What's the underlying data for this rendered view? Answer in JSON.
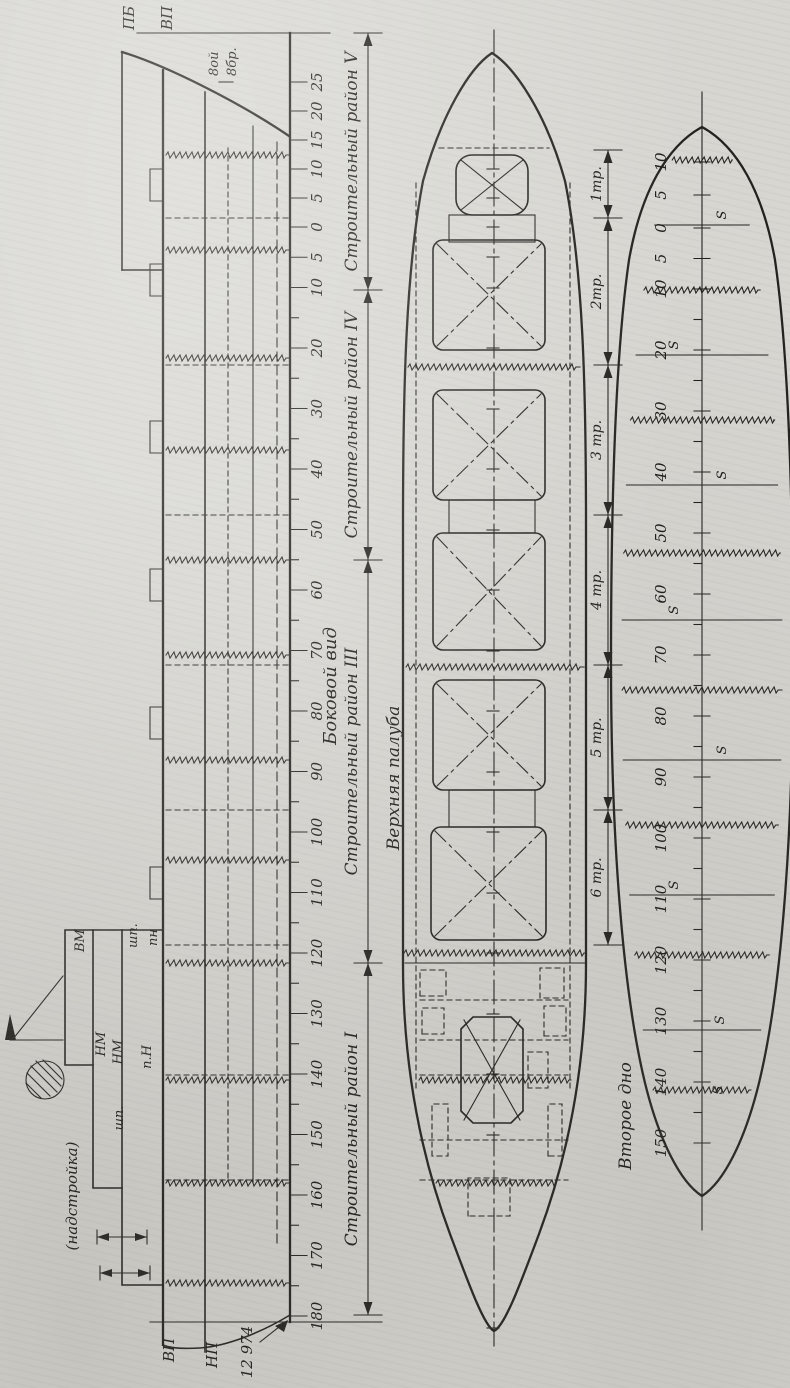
{
  "figure_titles": {
    "side_view": "Боковой вид",
    "upper_deck": "Верхняя палуба",
    "double_bottom": "Второе дно"
  },
  "deck_line_labels": {
    "pb": "ПБ",
    "vp": "ВП"
  },
  "stern_line_labels": {
    "vp": "ВП",
    "np": "НП"
  },
  "length_dimension": "12 974",
  "bow_note": {
    "line1": "8ой",
    "line2": "8бр."
  },
  "superstructure": {
    "note": "(надстройка)",
    "vm": "ВМ",
    "shp_upper": "шп.",
    "pn_upper": "пн",
    "nm_1": "НМ",
    "nm_2": "НМ",
    "p_n": "п.Н",
    "shp_lower": "шп."
  },
  "construction_regions": [
    "Строительный район V",
    "Строительный район IV",
    "Строительный район III",
    "Строительный район I"
  ],
  "holds": [
    "1тр.",
    "2тр.",
    "3 тр.",
    "4 тр.",
    "5 тр.",
    "6 тр."
  ],
  "side_frame_scale": {
    "forward": [
      "25",
      "20",
      "15",
      "10",
      "5"
    ],
    "zero": "0",
    "aft": [
      "5",
      "10",
      "20",
      "30",
      "40",
      "50",
      "60",
      "70",
      "80",
      "90",
      "100",
      "110",
      "120",
      "130",
      "140",
      "150",
      "160",
      "170",
      "180"
    ]
  },
  "bottom_frame_scale": {
    "forward": [
      "10",
      "5"
    ],
    "zero": "0",
    "aft": [
      "5",
      "10",
      "20",
      "30",
      "40",
      "50",
      "60",
      "70",
      "80",
      "90",
      "100",
      "110",
      "120",
      "130",
      "140",
      "150"
    ]
  },
  "weld_seam_mark": "S"
}
